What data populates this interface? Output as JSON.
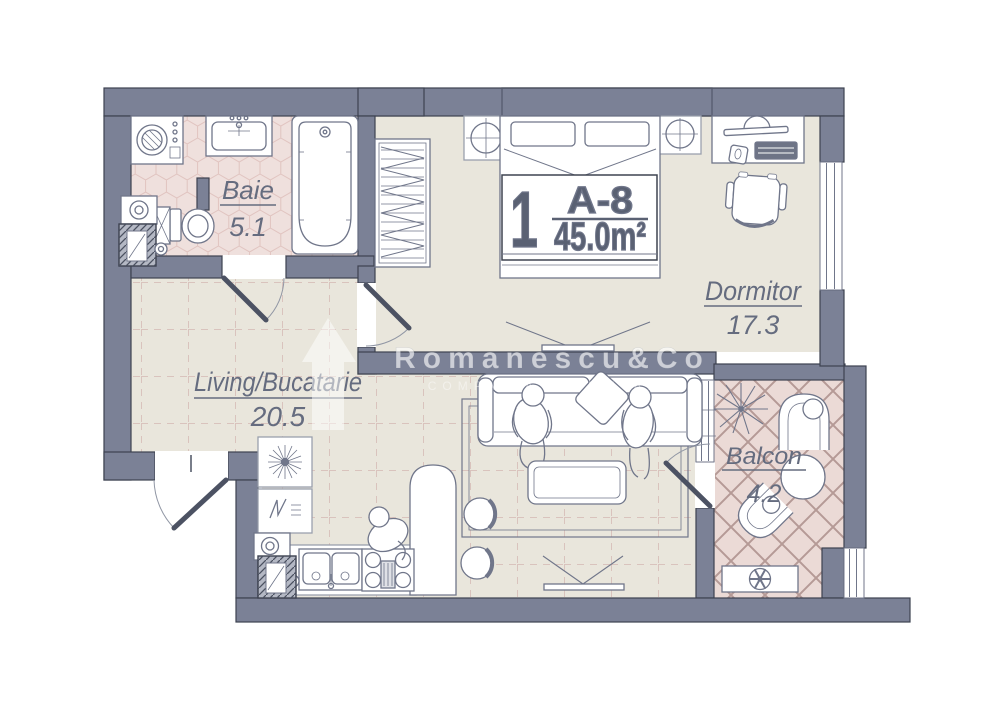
{
  "unit": {
    "number": "1",
    "code": "A-8",
    "area": "45.0m²"
  },
  "rooms": {
    "baie": {
      "name": "Baie",
      "area": "5.1"
    },
    "dormitor": {
      "name": "Dormitor",
      "area": "17.3"
    },
    "living": {
      "name": "Living/Bucatarie",
      "area": "20.5"
    },
    "balcon": {
      "name": "Balcon",
      "area": "4.2"
    }
  },
  "watermark": {
    "brand": "Romanescu&Co",
    "subtitle": "COMPANIA IMOBILIARA"
  },
  "symbols": {
    "ceiling_light": "circle-cross",
    "extractor_fan": "sunburst",
    "ac_fan": "flower",
    "plant": "starburst"
  },
  "colors": {
    "wall": "#7b8196",
    "wall_dark": "#6a7085",
    "bedroom_floor": "#e9e6dc",
    "bath_floor": "#efe0dd",
    "balcony_floor": "#ebdad6",
    "label_text": "#656c7f",
    "outline": "#3d4250"
  }
}
